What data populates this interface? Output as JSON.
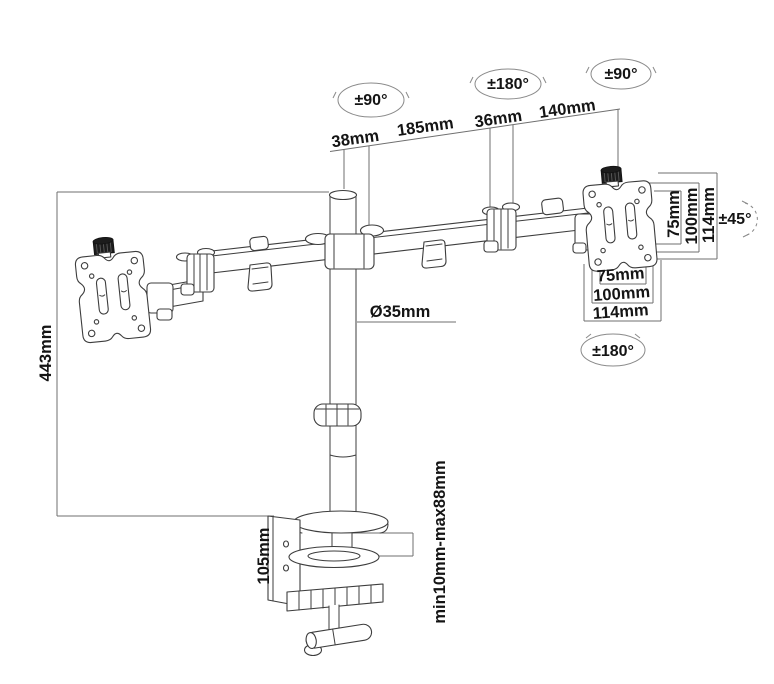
{
  "figure": {
    "type": "technical-diagram",
    "subject": "Dual monitor desk mount arm - dimension and rotation specification drawing",
    "background": "#ffffff",
    "line_color": "#3d3d3d",
    "dim_line_color": "#6f6f6f",
    "text_color": "#141414",
    "labels": {
      "rot_pole": "±90°",
      "rot_joint": "±180°",
      "rot_head": "±90°",
      "tilt_head": "±45°",
      "rot_vesa": "±180°",
      "seg_pole_width": "38mm",
      "seg_arm_inner": "185mm",
      "seg_joint_width": "36mm",
      "seg_arm_outer": "140mm",
      "pole_height": "443mm",
      "pole_diameter": "Ø35mm",
      "clamp_height": "105mm",
      "desk_thickness": "min10mm-max88mm",
      "vesa_side": [
        "75mm",
        "100mm",
        "114mm"
      ],
      "vesa_bottom": [
        "75mm",
        "100mm",
        "114mm"
      ]
    }
  }
}
